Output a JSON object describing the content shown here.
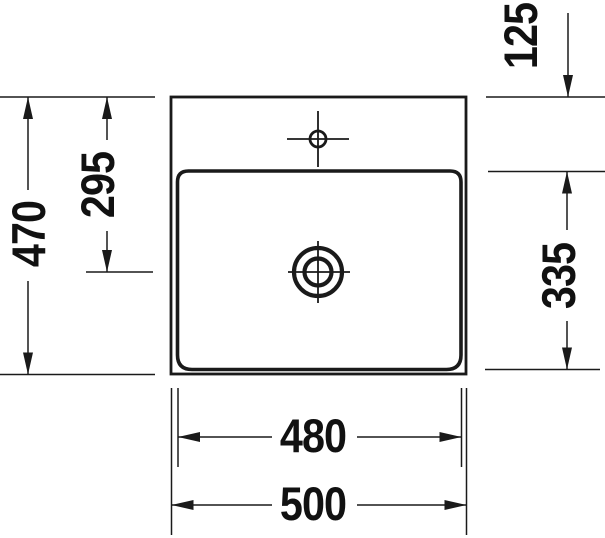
{
  "drawing": {
    "kind": "technical-dimension-drawing",
    "subject": "washbasin-top-view",
    "colors": {
      "background": "#ffffff",
      "line": "#1a1a1a",
      "text": "#111111"
    },
    "dimensions": {
      "left_outer_vertical": "470",
      "left_inner_vertical": "295",
      "top_right_vertical": "125",
      "right_vertical": "335",
      "bottom_inner_horizontal": "480",
      "bottom_outer_horizontal": "500"
    }
  }
}
